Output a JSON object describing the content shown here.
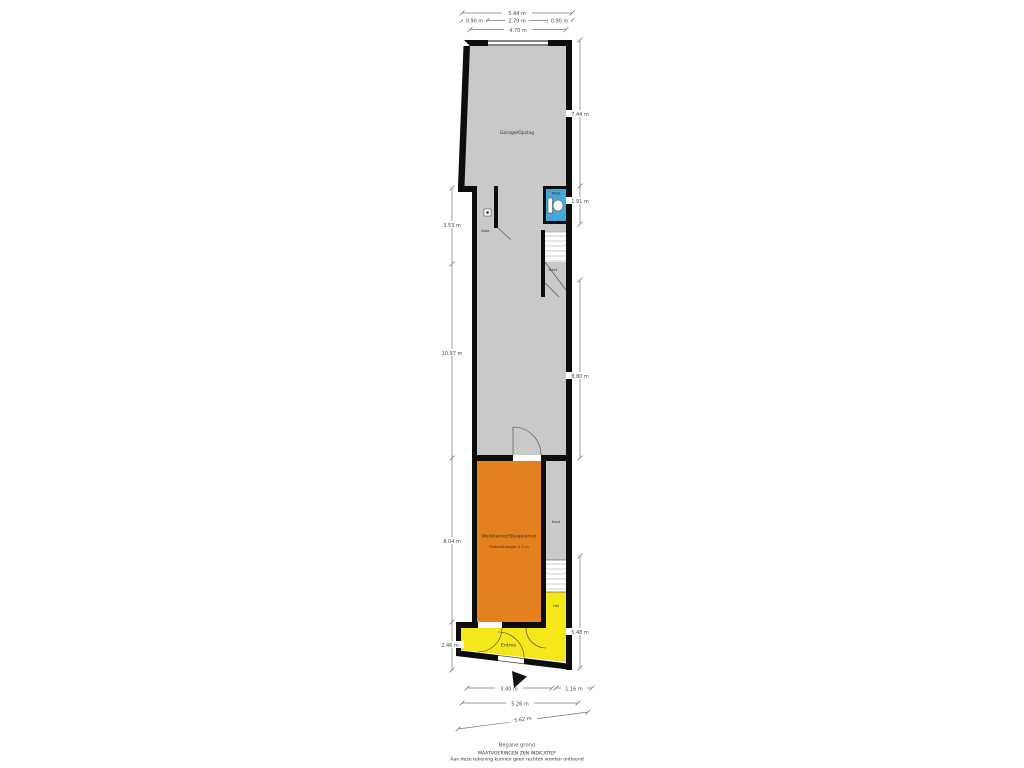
{
  "plan": {
    "footer": {
      "title": "Begane grond",
      "disclaimer1": "MAATVOERINGEN ZIJN INDICATIEF",
      "disclaimer2": "Aan deze tekening kunnen geen rechten worden ontleend"
    },
    "colors": {
      "wall": "#0d0d0d",
      "floor_gray": "#c9c9c9",
      "floor_orange": "#e5801f",
      "floor_yellow": "#f5e71a",
      "toilet_blue": "#44a8d9",
      "dim_line": "#7a7a7a"
    },
    "rooms": {
      "garage": {
        "label": "Garage/Opslag"
      },
      "kast_top": {
        "label": "Kast"
      },
      "toilet": {
        "label": "Toilet"
      },
      "kast_understairs": {
        "label": "Kast"
      },
      "werkkamer": {
        "label": "Werkkamer/Slaapkamer",
        "sublabel": "Plafondhoogte 2.5 m"
      },
      "kast_mid": {
        "label": "Kast"
      },
      "hal": {
        "label": "Hal"
      },
      "entree": {
        "label": "Entree"
      }
    },
    "dimensions": {
      "top_total": "5.44 m",
      "top_left": "0.90 m",
      "top_mid": "2.79 m",
      "top_right": "0.90 m",
      "top_inner": "4.70 m",
      "left_upper": "3.53 m",
      "left_mid": "10.97 m",
      "left_lower": "8.04 m",
      "left_bottom": "2.46 m",
      "right_top": "7.44 m",
      "right_toilet": "1.91 m",
      "right_mid": "8.80 m",
      "right_bottom": "5.48 m",
      "bottom_left": "3.40 m",
      "bottom_right": "1.16 m",
      "bottom_total": "5.26 m",
      "bottom_diag": "5.62 m"
    }
  }
}
